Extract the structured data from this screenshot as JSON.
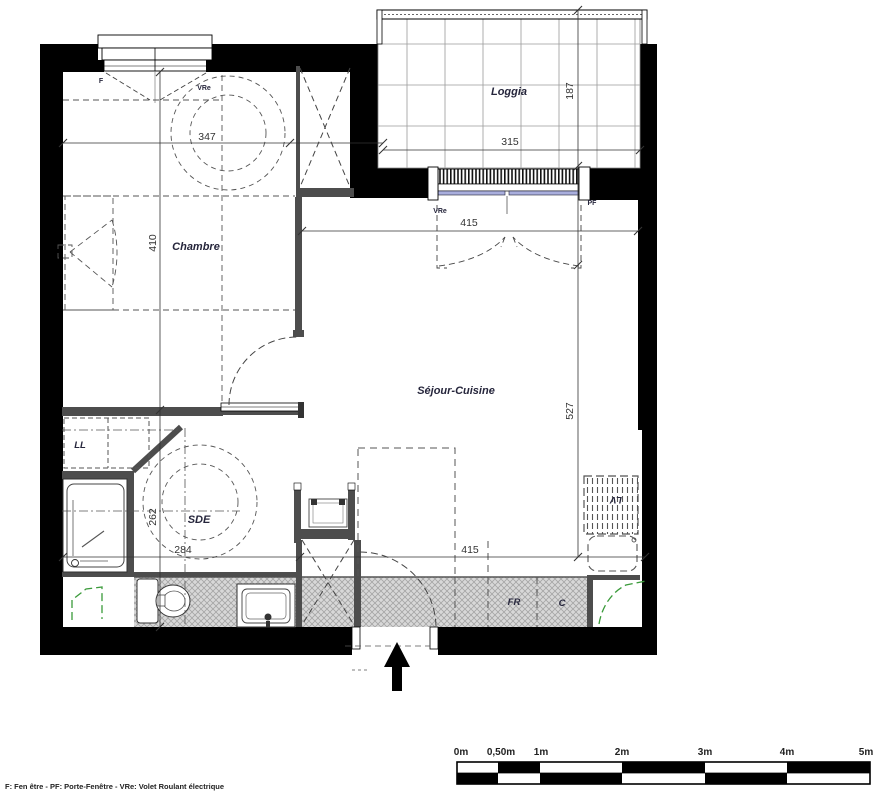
{
  "rooms": {
    "chambre": "Chambre",
    "loggia": "Loggia",
    "sejour_cuisine": "Séjour-Cuisine",
    "sde": "SDE"
  },
  "appliances": {
    "ll": "LL",
    "fr": "FR",
    "c": "C",
    "lv": "LV"
  },
  "openings": {
    "f": "F",
    "vre_chambre": "VRe",
    "vre_sejour": "VRe",
    "pf": "PF"
  },
  "dimensions": {
    "chambre_width": "347",
    "chambre_height": "410",
    "sde_height": "262",
    "sde_width": "284",
    "loggia_width": "315",
    "loggia_depth": "187",
    "sejour_width": "415",
    "sejour_height": "527",
    "kitchen_width": "415"
  },
  "scale_bar": {
    "labels": [
      "0m",
      "0,50m",
      "1m",
      "2m",
      "3m",
      "4m",
      "5m"
    ]
  },
  "legend": "F: Fen être - PF: Porte-Fenêtre - VRe: Volet Roulant électrique",
  "colors": {
    "wall": "#000000",
    "partition": "#4d4d4d",
    "floor": "#d8d8d8",
    "glazing": "#a9aedd",
    "duct_marker": "#3a9a3a"
  }
}
